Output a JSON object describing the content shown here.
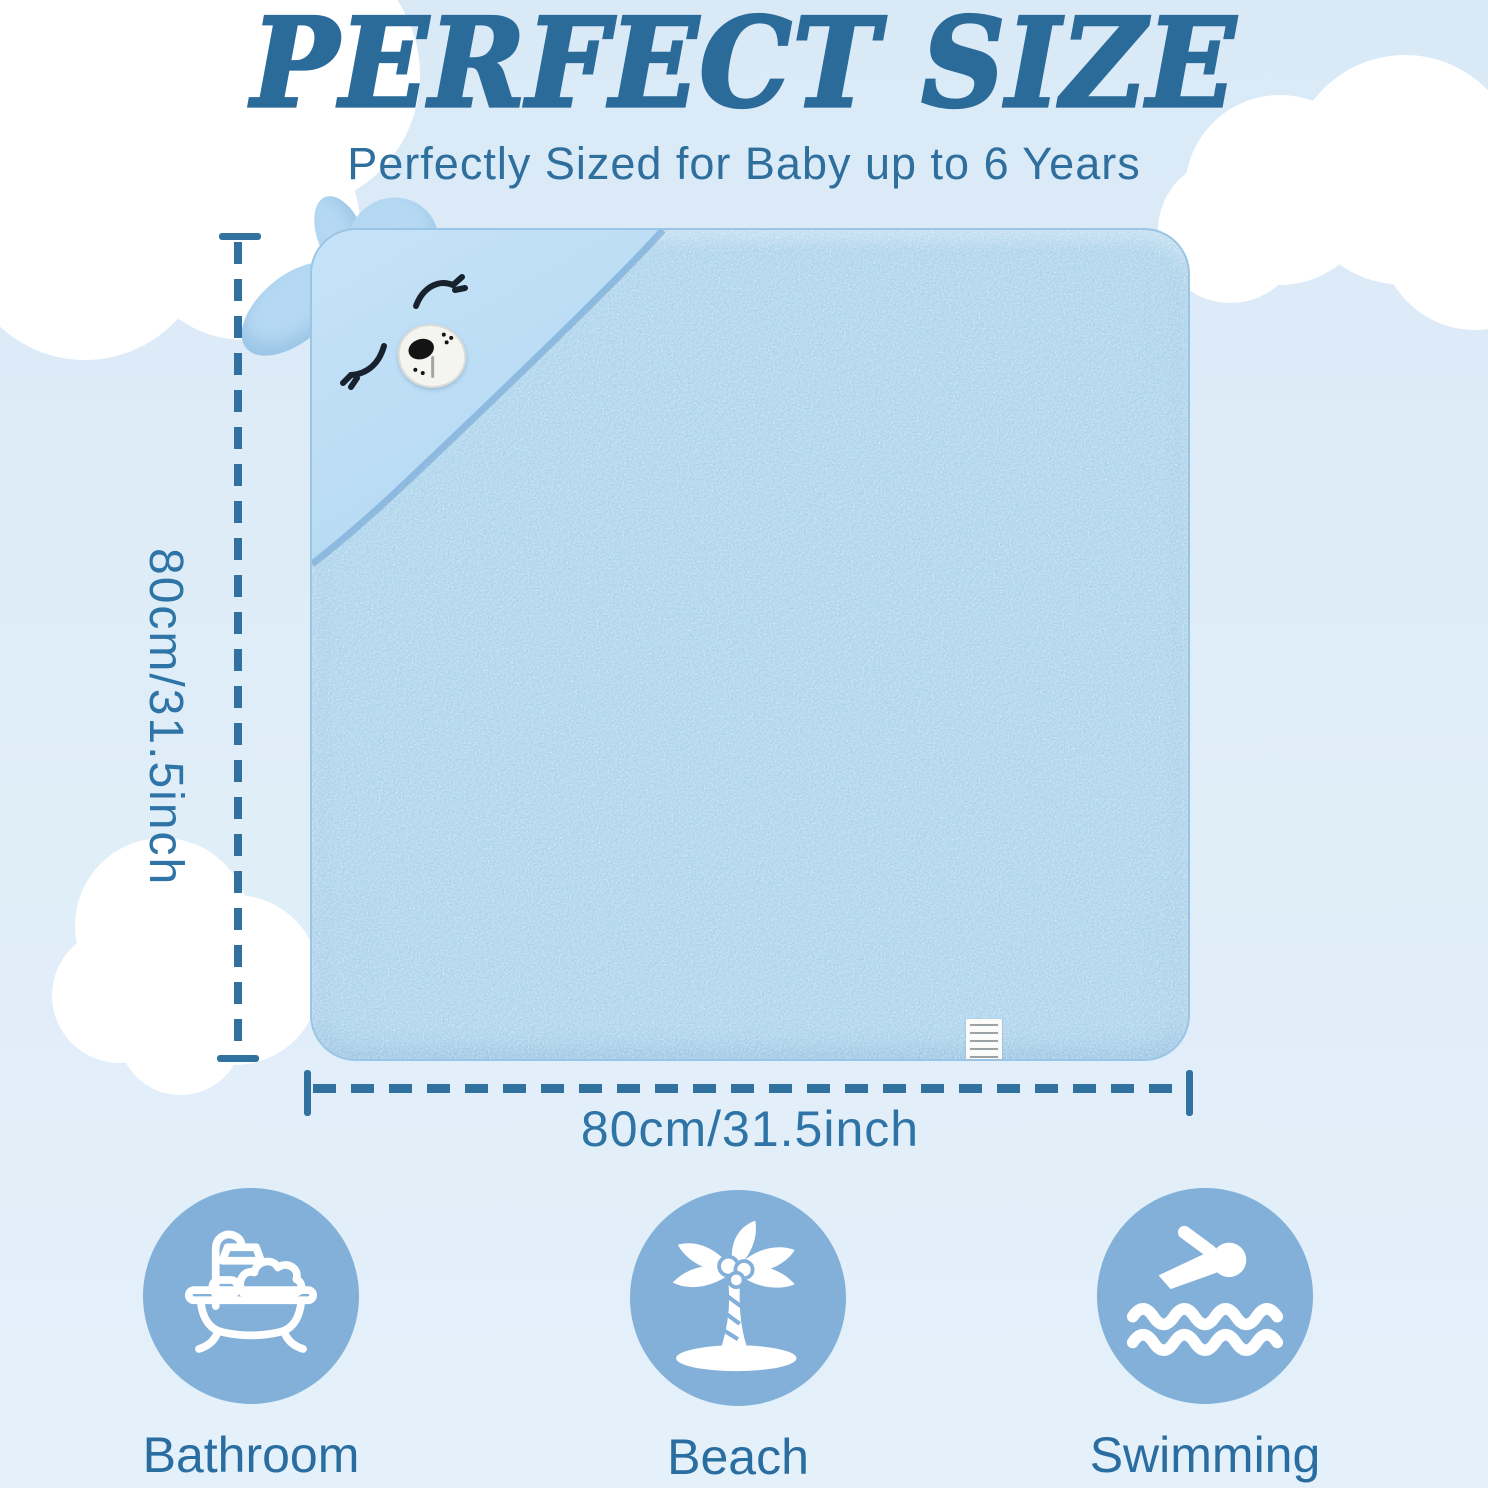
{
  "header": {
    "title": "PERFECT SIZE",
    "subtitle": "Perfectly Sized for Baby up to 6 Years"
  },
  "product": {
    "item": "hooded baby bath towel with bear face hood",
    "towel_color": "#abd3ec",
    "hood_color": "#bedff6"
  },
  "dimensions": {
    "height_label": "80cm/31.5inch",
    "width_label": "80cm/31.5inch",
    "line_color": "#31719f"
  },
  "features": [
    {
      "label": "Bathroom",
      "icon": "bathtub-shower-icon"
    },
    {
      "label": "Beach",
      "icon": "palm-tree-icon"
    },
    {
      "label": "Swimming",
      "icon": "swimmer-icon"
    }
  ],
  "colors": {
    "background": "#dfedf8",
    "title_blue": "#2a6b9a",
    "subtitle_blue": "#2e6f9e",
    "dimension_blue": "#31719f",
    "feature_circle_blue": "#83b0d8",
    "feature_label_blue": "#2a6da1",
    "cloud_white": "#ffffff"
  }
}
